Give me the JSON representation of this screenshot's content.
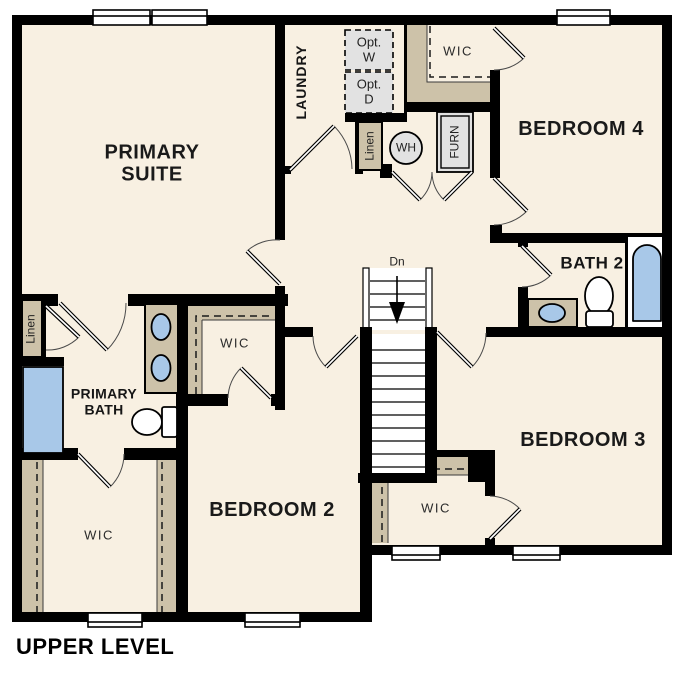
{
  "plan": {
    "title": "UPPER LEVEL"
  },
  "rooms": {
    "primary_suite": {
      "label": "PRIMARY SUITE"
    },
    "laundry": {
      "label": "LAUNDRY"
    },
    "wic_top": {
      "label": "WIC"
    },
    "bedroom_4": {
      "label": "BEDROOM 4"
    },
    "bath_2": {
      "label": "BATH 2"
    },
    "primary_bath": {
      "label": "PRIMARY BATH"
    },
    "wic_middle": {
      "label": "WIC"
    },
    "wic_primary": {
      "label": "WIC"
    },
    "bedroom_2": {
      "label": "BEDROOM 2"
    },
    "wic_bedroom3": {
      "label": "WIC"
    },
    "bedroom_3": {
      "label": "BEDROOM 3"
    }
  },
  "closets": {
    "linen_top": {
      "label": "Linen"
    },
    "linen_left": {
      "label": "Linen"
    }
  },
  "equipment": {
    "washer_opt": {
      "label": "Opt. W"
    },
    "dryer_opt": {
      "label": "Opt. D"
    },
    "water_heater": {
      "label": "WH"
    },
    "furnace": {
      "label": "FURN"
    }
  },
  "stairs": {
    "direction_label": "Dn"
  },
  "colors": {
    "wall": "#000000",
    "floor": "#f8f0e2",
    "casework": "#cdc2a9",
    "fixture_blue": "#a8c8e8",
    "appliance_gray": "#e2e2e2",
    "exterior": "#ffffff"
  }
}
